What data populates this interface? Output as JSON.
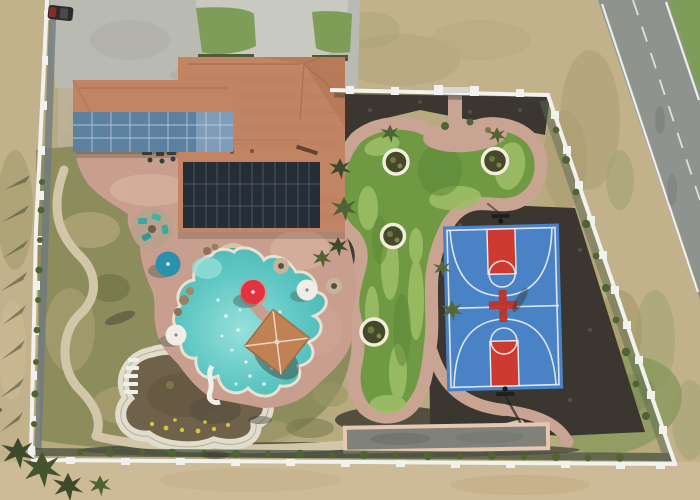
{
  "scene": {
    "type": "aerial-photograph",
    "description": "Aerial drone photo of a resort-style backyard: house with rooftop solar array and blue panel carport, freeform swimming pool with spa, red / teal / white patio umbrellas, gazebo, lazy-river walkway, freeform putting green with four ringed planters, blue basketball court with red keys, long bocce court, white vinyl perimeter fence, dry desert lot and a two-lane road along the right side",
    "features": [
      "driveway",
      "turnaround-circle",
      "parked-car",
      "main-house",
      "rooftop-solar-array",
      "garage-wing-blue-panels",
      "patio",
      "swimming-pool",
      "spa",
      "red-umbrella",
      "teal-umbrella",
      "white-umbrellas",
      "gazebo",
      "fire-pits",
      "seating-circle",
      "lazy-river",
      "garden-bed",
      "putting-green",
      "planter-rings",
      "basketball-court",
      "court-logo",
      "hoops",
      "bocce-court",
      "perimeter-fence",
      "gate",
      "road",
      "lawn",
      "shrub-rows",
      "dry-field"
    ]
  },
  "colors": {
    "ground-dry": "#c2b28c",
    "ground-dirt": "#cdbb97",
    "ground-olive": "#a29a6c",
    "concrete": "#b9bab2",
    "concrete-light": "#c8c9c1",
    "road": "#8f9390",
    "road-line": "#eceee9",
    "grass-green": "#7d9d58",
    "lawn": "#8d8c5c",
    "roof": "#c28462",
    "roof-dark": "#b07252",
    "solar-dark": "#252d36",
    "solar-grid": "#46566a",
    "panel-blue": "#5c80a0",
    "panel-blue-light": "#7f9db8",
    "patio": "#c89e8f",
    "patio-light": "#d8b3a2",
    "path-tan": "#d2c6a8",
    "path-pink": "#c9a492",
    "pool": "#52c0bc",
    "pool-light": "#93ded9",
    "spa": "#3aaea9",
    "pool-edge": "#e9e2d2",
    "green-turf": "#6f9a43",
    "green-light": "#9dbf68",
    "green-dark": "#5b8536",
    "ring-white": "#f2eed9",
    "court-blue": "#4a82c6",
    "court-red": "#cd3a30",
    "court-line": "#e9eef5",
    "mulch": "#3b3730",
    "fence": "#f1f2ee",
    "fence-shadow": "#6d7883",
    "umb-red": "#e2333f",
    "umb-blue": "#2b92ae",
    "umb-white": "#efede6",
    "bocce": "#80827a",
    "bocce-border": "#e5c7b2",
    "veg": "#4f6334",
    "veg-dark": "#3f4a2c",
    "river-bed": "#70624a",
    "flower-yellow": "#d4c636"
  }
}
